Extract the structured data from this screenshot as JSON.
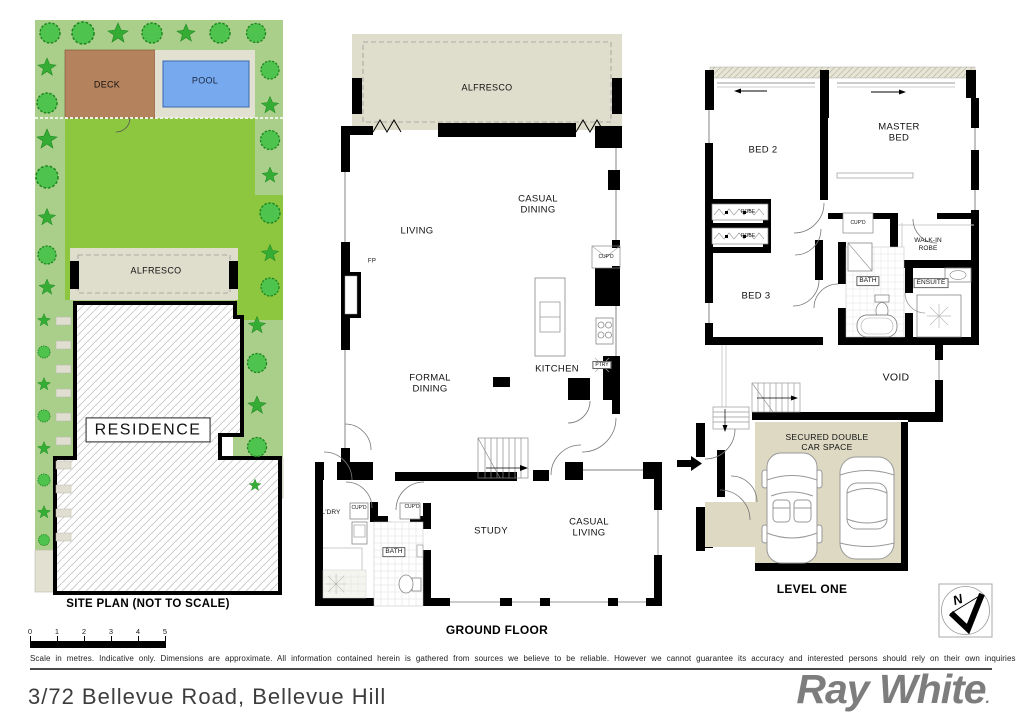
{
  "address": "3/72 Bellevue Road, Bellevue Hill",
  "brand": {
    "name": "Ray White",
    "dot": "."
  },
  "disclaimer": "Scale in metres. Indicative only. Dimensions are approximate. All information contained herein is gathered from sources we believe to be reliable. However we cannot guarantee its accuracy and interested persons should rely on their own inquiries",
  "scale_bar": {
    "ticks": [
      "0",
      "1",
      "2",
      "3",
      "4",
      "5"
    ]
  },
  "compass": {
    "north": "N"
  },
  "site_plan": {
    "title": "SITE PLAN (NOT TO SCALE)",
    "deck": "DECK",
    "pool": "POOL",
    "alfresco": "ALFRESCO",
    "residence": "RESIDENCE"
  },
  "ground_floor": {
    "title": "GROUND FLOOR",
    "alfresco": "ALFRESCO",
    "living": "LIVING",
    "casual_dining": "CASUAL DINING",
    "formal_dining": "FORMAL DINING",
    "kitchen": "KITCHEN",
    "pantry": "PTRY",
    "fireplace": "FP",
    "cupboard": "CUP'D",
    "laundry": "L'DRY",
    "cupboard2": "CUP'D",
    "cupboard3": "CUP'D",
    "bath": "BATH",
    "study": "STUDY",
    "casual_living": "CASUAL LIVING"
  },
  "level_one": {
    "title": "LEVEL ONE",
    "bed2": "BED 2",
    "master_bed": "MASTER BED",
    "bed3": "BED 3",
    "robe1": "ROBE",
    "robe2": "ROBE",
    "cupboard": "CUP'D",
    "walk_in_robe": "WALK-IN ROBE",
    "bath": "BATH",
    "ensuite": "ENSUITE",
    "void": "VOID",
    "car_space": "SECURED DOUBLE CAR SPACE"
  },
  "colors": {
    "garden": "#a9cf8b",
    "lawn": "#8dc63f",
    "deck": "#b5825e",
    "pool": "#76a9ed",
    "paving": "#e2e1d1",
    "alfresco": "#dfddcc",
    "tree": "#4ec44e",
    "wall": "#000000",
    "logo_gray": "#7d7d7d"
  }
}
